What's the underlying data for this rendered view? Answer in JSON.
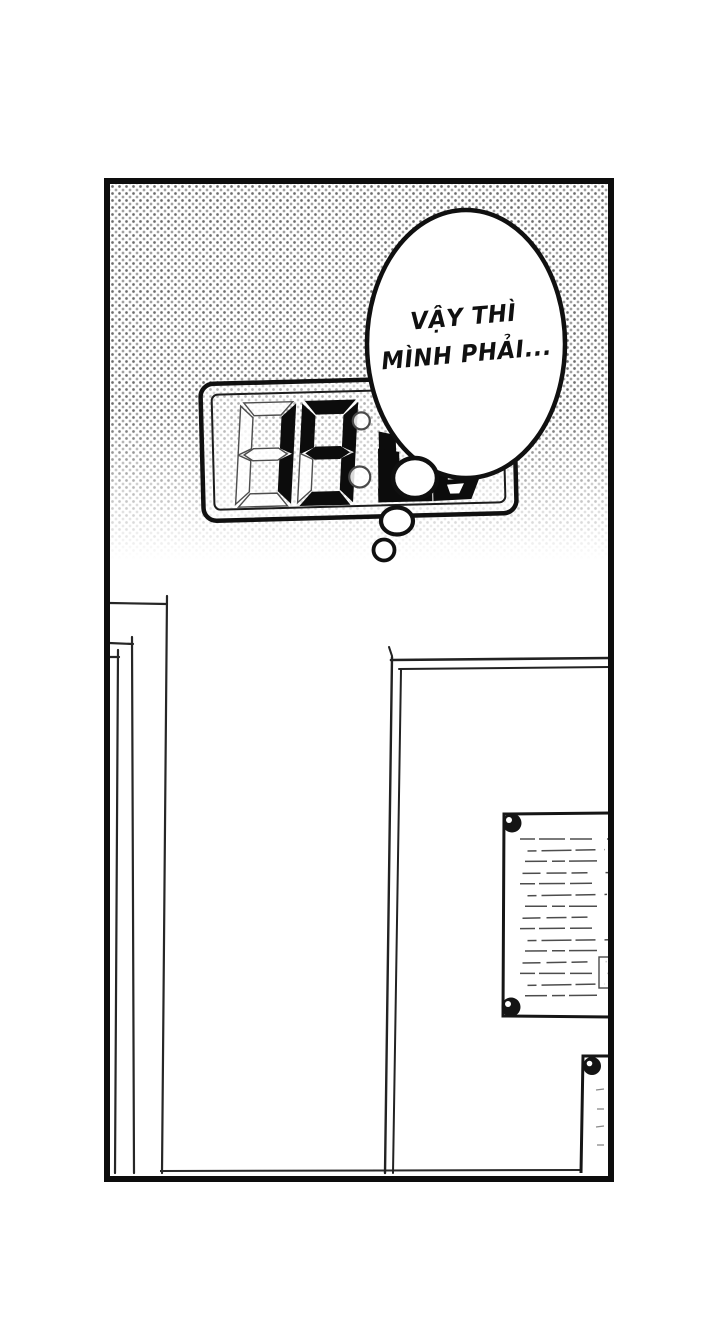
{
  "scene": {
    "paper_color": "#ffffff",
    "ink_color": "#101010"
  },
  "thought_bubble": {
    "lines": [
      "VẬY THÌ",
      "MÌNH PHẢI..."
    ]
  },
  "clock": {
    "hour_digits": "19"
  },
  "vent": {
    "slat_count": 15
  }
}
